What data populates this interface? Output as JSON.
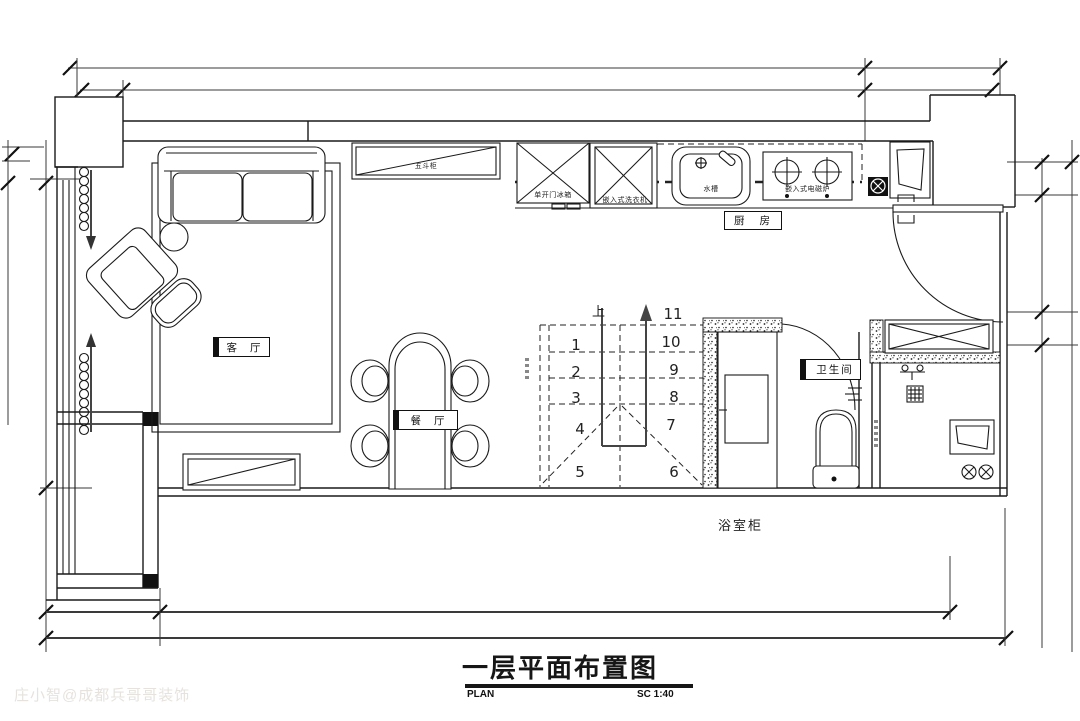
{
  "rooms": {
    "living_room": "客 厅",
    "dining_room": "餐 厅",
    "kitchen": "厨 房",
    "bathroom": "卫生间"
  },
  "fixtures": {
    "dresser": "五斗柜",
    "fridge": "单开门冰箱",
    "washer": "嵌入式洗衣机",
    "sink": "水槽",
    "cooktop": "嵌入式电磁炉",
    "bath_cabinet": "浴室柜"
  },
  "stairs": {
    "up": "上",
    "steps": [
      "1",
      "2",
      "3",
      "4",
      "5",
      "6",
      "7",
      "8",
      "9",
      "10",
      "11"
    ]
  },
  "title_block": {
    "title": "一层平面布置图",
    "plan": "PLAN",
    "scale": "SC 1:40"
  },
  "watermark": "庄小智@成都兵哥哥装饰",
  "colors": {
    "line": "#1a1a1a",
    "dimension": "#3a3a3a",
    "watermark_text": "#e6e3de"
  }
}
